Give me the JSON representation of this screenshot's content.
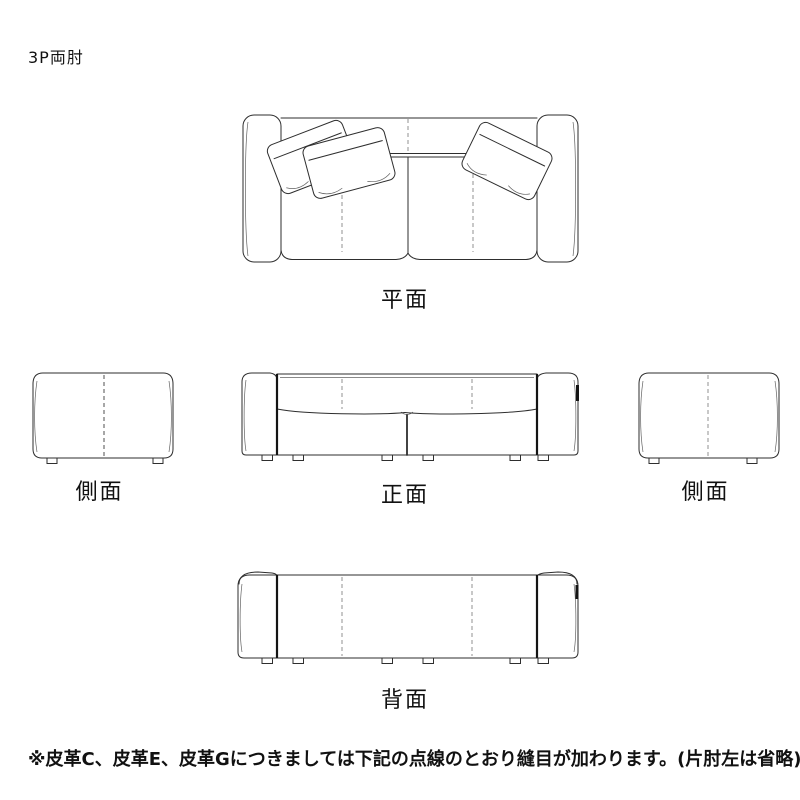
{
  "theme": {
    "background": "#ffffff",
    "line_color": "#2e2e2e",
    "thick_line_color": "#141414",
    "stitch_color": "#909090",
    "stitch_dark_color": "#4f4f4f",
    "text_color": "#111111"
  },
  "header": {
    "title": "3P両肘"
  },
  "views": {
    "plan": {
      "label": "平面"
    },
    "side_left": {
      "label": "側面"
    },
    "front": {
      "label": "正面"
    },
    "side_right": {
      "label": "側面"
    },
    "back": {
      "label": "背面"
    }
  },
  "footnote": {
    "text": "※皮革C、皮革E、皮革Gにつきましては下記の点線のとおり縫目が加わります。(片肘左は省略)"
  }
}
